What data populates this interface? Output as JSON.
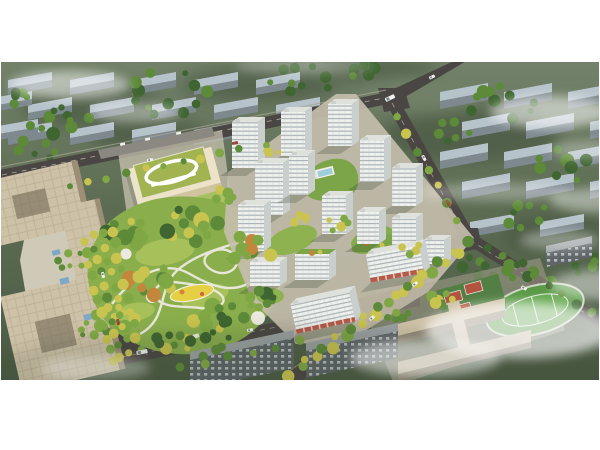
{
  "meta": {
    "type": "architectural-aerial-render",
    "description": "Bird's-eye masterplan rendering of a residential development: white high-rise apartment towers around green courtyards, a central landscaped park with a yellow playground, a kindergarten with a green roof and white loop, beige office towers and plaza to the west, a wide tree-lined avenue, a commercial street with red awnings, a school campus with running track and red courts to the southeast, all surrounded by a muted existing city with rows of grey slab buildings and drifting low clouds. White page margins above and below the render."
  },
  "landmarks": [
    {
      "name": "residential-towers",
      "desc": "Cluster of white high-rise apartment buildings with banded windows"
    },
    {
      "name": "central-park",
      "desc": "Landscaped park with winding white paths, lawns and playground"
    },
    {
      "name": "kindergarten",
      "desc": "Low school building with green roof and white racetrack loop"
    },
    {
      "name": "office-complex",
      "desc": "Beige office towers with rooftop grids and landscaped plaza"
    },
    {
      "name": "tree-lined-avenue",
      "desc": "Wide boulevard with four rows of yellow trees"
    },
    {
      "name": "commercial-street",
      "desc": "Retail frontage with red awnings along the boulevard"
    },
    {
      "name": "school-campus",
      "desc": "Long school buildings with green sports field, track and red courts"
    },
    {
      "name": "context-city",
      "desc": "Muted grey-green existing city blocks under light fog and clouds"
    }
  ],
  "palette": {
    "page_bg": "#ffffff",
    "terrain_top": "#73826a",
    "terrain_mid": "#5d6d53",
    "terrain_bottom": "#4b5a44",
    "context_roof": "#b7c3cb",
    "context_side": "#7d898f",
    "road": "#4a4643",
    "road_line": "#cfc9ba",
    "sidewalk": "#a8a194",
    "tower_front": "#eff1ed",
    "tower_side": "#c9cfcc",
    "tower_stripe": "#a2abb0",
    "roof_flat": "#dfe2dc",
    "courtyard_green": "#7ca448",
    "park_lawn": "#8aae4c",
    "lawn_light": "#a9c35c",
    "tree_dark": "#3f6530",
    "tree_mid": "#5d8a39",
    "tree_light": "#7fa845",
    "tree_yellow": "#c9c44f",
    "tree_orange": "#c3873c",
    "path_white": "#eceadf",
    "playground_yellow": "#e5d044",
    "pool_blue": "#9fcdd8",
    "plaza": "#d6cfbd",
    "office_roof": "#cdc1a7",
    "office_side": "#9d8f76",
    "kinder_roof": "#a2b452",
    "kinder_body": "#ece3c9",
    "school_roof": "#cfc2a8",
    "school_side": "#8f8572",
    "track_green": "#5a9a46",
    "field_green": "#63a84e",
    "court_red": "#b2543f",
    "court_pad": "#4f8040",
    "city_roof": "#9ba1a3",
    "city_front": "#5e6468",
    "city_window": "#c6ccce",
    "awning_red": "#b04a38",
    "canopy_blue": "#7fa7c9",
    "parking": "#8b8781",
    "cloud": "#ffffff",
    "shadow": "#26301f",
    "car_white": "#f2f2f0",
    "car_red": "#b03a2c"
  },
  "context": {
    "grids": [
      {
        "x0": 8,
        "y0": 80,
        "cols": 5,
        "rows": 3,
        "dx": 62,
        "dy": 25,
        "stagger": 20,
        "w": 44,
        "slope": 8,
        "rh": 8,
        "fh": 7,
        "skip": [
          "2,4"
        ]
      },
      {
        "x0": 440,
        "y0": 92,
        "cols": 3,
        "rows": 4,
        "dx": 64,
        "dy": 30,
        "stagger": 22,
        "w": 48,
        "slope": 9,
        "rh": 9,
        "fh": 8,
        "skip": []
      },
      {
        "x0": 470,
        "y0": 222,
        "cols": 2,
        "rows": 1,
        "dx": 70,
        "dy": 30,
        "stagger": 0,
        "w": 44,
        "slope": 8,
        "rh": 8,
        "fh": 7,
        "skip": []
      },
      {
        "x0": -8,
        "y0": 98,
        "cols": 1,
        "rows": 2,
        "dx": 60,
        "dy": 28,
        "stagger": 6,
        "w": 40,
        "slope": 7,
        "rh": 8,
        "fh": 6,
        "skip": []
      }
    ]
  },
  "towers": [
    {
      "x": 328,
      "y": 104,
      "w": 24,
      "h": 42
    },
    {
      "x": 281,
      "y": 112,
      "w": 24,
      "h": 44
    },
    {
      "x": 232,
      "y": 122,
      "w": 26,
      "h": 46
    },
    {
      "x": 360,
      "y": 140,
      "w": 24,
      "h": 42
    },
    {
      "x": 255,
      "y": 163,
      "w": 28,
      "h": 52
    },
    {
      "x": 289,
      "y": 155,
      "w": 19,
      "h": 40
    },
    {
      "x": 392,
      "y": 168,
      "w": 24,
      "h": 38
    },
    {
      "x": 238,
      "y": 205,
      "w": 26,
      "h": 46
    },
    {
      "x": 322,
      "y": 196,
      "w": 24,
      "h": 38
    },
    {
      "x": 357,
      "y": 212,
      "w": 22,
      "h": 32
    },
    {
      "x": 392,
      "y": 218,
      "w": 24,
      "h": 32
    },
    {
      "x": 424,
      "y": 240,
      "w": 20,
      "h": 24
    },
    {
      "x": 250,
      "y": 262,
      "w": 30,
      "h": 24
    },
    {
      "x": 295,
      "y": 254,
      "w": 34,
      "h": 26,
      "garden": true
    },
    {
      "x": 368,
      "y": 250,
      "w": 54,
      "h": 28,
      "shops": true,
      "rot": -10
    },
    {
      "x": 293,
      "y": 298,
      "w": 60,
      "h": 30,
      "shops": true,
      "rot": -12
    }
  ],
  "vegetation": {
    "clusters": [
      {
        "layer": "ctx",
        "cx": 60,
        "cy": 118,
        "spread": 34,
        "n": 10,
        "rmin": 3,
        "rmax": 7,
        "pal": [
          "tree_dark",
          "tree_mid"
        ]
      },
      {
        "layer": "ctx",
        "cx": 165,
        "cy": 95,
        "spread": 44,
        "n": 12,
        "rmin": 3,
        "rmax": 7,
        "pal": [
          "tree_dark",
          "tree_mid"
        ]
      },
      {
        "layer": "ctx",
        "cx": 300,
        "cy": 78,
        "spread": 34,
        "n": 9,
        "rmin": 3,
        "rmax": 6,
        "pal": [
          "tree_dark",
          "tree_mid"
        ]
      },
      {
        "layer": "ctx",
        "cx": 368,
        "cy": 68,
        "spread": 24,
        "n": 6,
        "rmin": 3,
        "rmax": 6,
        "pal": [
          "tree_dark",
          "tree_mid"
        ]
      },
      {
        "layer": "ctx",
        "cx": 495,
        "cy": 100,
        "spread": 40,
        "n": 10,
        "rmin": 3,
        "rmax": 7,
        "pal": [
          "tree_dark",
          "tree_mid"
        ]
      },
      {
        "layer": "ctx",
        "cx": 565,
        "cy": 165,
        "spread": 30,
        "n": 8,
        "rmin": 3,
        "rmax": 7,
        "pal": [
          "tree_dark",
          "tree_mid"
        ]
      },
      {
        "layer": "ctx",
        "cx": 520,
        "cy": 212,
        "spread": 26,
        "n": 7,
        "rmin": 3,
        "rmax": 6,
        "pal": [
          "tree_dark",
          "tree_mid"
        ]
      },
      {
        "layer": "ctx",
        "cx": 35,
        "cy": 150,
        "spread": 22,
        "n": 6,
        "rmin": 3,
        "rmax": 6,
        "pal": [
          "tree_dark",
          "tree_mid"
        ]
      },
      {
        "layer": "ctx",
        "cx": 450,
        "cy": 130,
        "spread": 22,
        "n": 6,
        "rmin": 3,
        "rmax": 6,
        "pal": [
          "tree_dark",
          "tree_mid"
        ]
      },
      {
        "layer": "ctx",
        "cx": 590,
        "cy": 262,
        "spread": 22,
        "n": 6,
        "rmin": 3,
        "rmax": 6,
        "pal": [
          "tree_dark",
          "tree_mid"
        ]
      },
      {
        "layer": "ctx",
        "cx": 553,
        "cy": 298,
        "spread": 28,
        "n": 8,
        "rmin": 3,
        "rmax": 7,
        "pal": [
          "tree_dark",
          "tree_mid"
        ]
      },
      {
        "layer": "ctx",
        "cx": 480,
        "cy": 268,
        "spread": 20,
        "n": 6,
        "rmin": 3,
        "rmax": 6,
        "pal": [
          "tree_dark",
          "tree_mid"
        ]
      },
      {
        "layer": "ctx",
        "cx": 18,
        "cy": 95,
        "spread": 16,
        "n": 5,
        "rmin": 3,
        "rmax": 6,
        "pal": [
          "tree_dark",
          "tree_mid"
        ]
      },
      {
        "layer": "site",
        "cx": 132,
        "cy": 232,
        "spread": 26,
        "n": 10,
        "rmin": 3.5,
        "rmax": 8,
        "pal": [
          "tree_mid",
          "tree_light",
          "tree_dark",
          "tree_yellow"
        ]
      },
      {
        "layer": "site",
        "cx": 192,
        "cy": 224,
        "spread": 30,
        "n": 12,
        "rmin": 3.5,
        "rmax": 8,
        "pal": [
          "tree_mid",
          "tree_light",
          "tree_dark",
          "tree_yellow"
        ]
      },
      {
        "layer": "site",
        "cx": 250,
        "cy": 250,
        "spread": 24,
        "n": 10,
        "rmin": 3.5,
        "rmax": 7,
        "pal": [
          "tree_mid",
          "tree_light",
          "tree_yellow",
          "tree_orange"
        ]
      },
      {
        "layer": "site",
        "cx": 150,
        "cy": 282,
        "spread": 28,
        "n": 11,
        "rmin": 3.5,
        "rmax": 8,
        "pal": [
          "tree_mid",
          "tree_light",
          "tree_orange",
          "tree_yellow"
        ]
      },
      {
        "layer": "site",
        "cx": 218,
        "cy": 318,
        "spread": 30,
        "n": 12,
        "rmin": 3.5,
        "rmax": 8,
        "pal": [
          "tree_dark",
          "tree_mid",
          "tree_light",
          "tree_yellow"
        ]
      },
      {
        "layer": "site",
        "cx": 116,
        "cy": 318,
        "spread": 20,
        "n": 8,
        "rmin": 3,
        "rmax": 7,
        "pal": [
          "tree_mid",
          "tree_light",
          "tree_yellow"
        ]
      },
      {
        "layer": "site",
        "cx": 264,
        "cy": 300,
        "spread": 18,
        "n": 8,
        "rmin": 3,
        "rmax": 7,
        "pal": [
          "tree_mid",
          "tree_light",
          "tree_dark"
        ]
      },
      {
        "layer": "site",
        "cx": 172,
        "cy": 342,
        "spread": 20,
        "n": 8,
        "rmin": 3,
        "rmax": 6,
        "pal": [
          "tree_mid",
          "tree_dark",
          "tree_yellow"
        ]
      },
      {
        "layer": "site",
        "cx": 70,
        "cy": 260,
        "spread": 15,
        "n": 6,
        "rmin": 2.5,
        "rmax": 5,
        "pal": [
          "tree_mid",
          "tree_light"
        ]
      },
      {
        "layer": "site",
        "cx": 95,
        "cy": 330,
        "spread": 15,
        "n": 6,
        "rmin": 2.5,
        "rmax": 5,
        "pal": [
          "tree_mid",
          "tree_light"
        ]
      },
      {
        "layer": "site",
        "cx": 226,
        "cy": 196,
        "spread": 14,
        "n": 5,
        "rmin": 3,
        "rmax": 6,
        "pal": [
          "tree_light",
          "tree_yellow"
        ]
      },
      {
        "layer": "site",
        "cx": 340,
        "cy": 224,
        "spread": 13,
        "n": 5,
        "rmin": 2.5,
        "rmax": 5,
        "pal": [
          "tree_yellow",
          "tree_light"
        ]
      },
      {
        "layer": "site",
        "cx": 300,
        "cy": 218,
        "spread": 9,
        "n": 4,
        "rmin": 2.5,
        "rmax": 5,
        "pal": [
          "tree_yellow",
          "tree_light"
        ]
      },
      {
        "layer": "site",
        "cx": 412,
        "cy": 248,
        "spread": 11,
        "n": 4,
        "rmin": 2.5,
        "rmax": 5,
        "pal": [
          "tree_yellow",
          "tree_light"
        ]
      },
      {
        "layer": "site",
        "cx": 270,
        "cy": 150,
        "spread": 10,
        "n": 4,
        "rmin": 2.5,
        "rmax": 5,
        "pal": [
          "tree_yellow",
          "tree_light"
        ]
      },
      {
        "layer": "site",
        "cx": 440,
        "cy": 300,
        "spread": 16,
        "n": 6,
        "rmin": 3,
        "rmax": 6,
        "pal": [
          "tree_mid",
          "tree_yellow",
          "tree_light"
        ]
      },
      {
        "layer": "site",
        "cx": 522,
        "cy": 272,
        "spread": 18,
        "n": 6,
        "rmin": 3,
        "rmax": 6,
        "pal": [
          "tree_dark",
          "tree_mid"
        ]
      },
      {
        "layer": "site",
        "cx": 210,
        "cy": 344,
        "spread": 22,
        "n": 7,
        "rmin": 3,
        "rmax": 6,
        "pal": [
          "tree_mid",
          "tree_dark"
        ]
      },
      {
        "layer": "site",
        "cx": 398,
        "cy": 316,
        "spread": 14,
        "n": 5,
        "rmin": 3,
        "rmax": 5,
        "pal": [
          "tree_mid",
          "tree_light"
        ]
      }
    ],
    "rows": [
      {
        "x1": 70,
        "y1": 186,
        "x2": 240,
        "y2": 149,
        "n": 10,
        "r": 3.5,
        "pal": [
          "tree_mid",
          "tree_yellow",
          "tree_light"
        ]
      },
      {
        "x1": 84,
        "y1": 240,
        "x2": 112,
        "y2": 362,
        "n": 11,
        "r": 4.5,
        "pal": [
          "tree_yellow",
          "tree_light"
        ]
      },
      {
        "x1": 93,
        "y1": 236,
        "x2": 121,
        "y2": 358,
        "n": 11,
        "r": 4,
        "pal": [
          "tree_yellow",
          "tree_mid"
        ]
      },
      {
        "x1": 102,
        "y1": 233,
        "x2": 130,
        "y2": 354,
        "n": 10,
        "r": 4,
        "pal": [
          "tree_light",
          "tree_yellow"
        ]
      },
      {
        "x1": 111,
        "y1": 231,
        "x2": 140,
        "y2": 351,
        "n": 10,
        "r": 4.5,
        "pal": [
          "tree_yellow",
          "tree_light"
        ]
      },
      {
        "x1": 290,
        "y1": 378,
        "x2": 460,
        "y2": 252,
        "n": 13,
        "r": 5,
        "pal": [
          "tree_yellow",
          "tree_light",
          "tree_yellow"
        ]
      },
      {
        "x1": 306,
        "y1": 360,
        "x2": 468,
        "y2": 242,
        "n": 12,
        "r": 4.5,
        "pal": [
          "tree_yellow",
          "tree_mid"
        ]
      },
      {
        "x1": 398,
        "y1": 116,
        "x2": 458,
        "y2": 222,
        "n": 7,
        "r": 4,
        "pal": [
          "tree_light",
          "tree_yellow",
          "tree_mid"
        ]
      },
      {
        "x1": 488,
        "y1": 246,
        "x2": 592,
        "y2": 312,
        "n": 8,
        "r": 4,
        "pal": [
          "tree_dark",
          "tree_mid"
        ]
      },
      {
        "x1": 180,
        "y1": 368,
        "x2": 300,
        "y2": 342,
        "n": 6,
        "r": 4,
        "pal": [
          "tree_mid",
          "tree_light"
        ]
      }
    ]
  },
  "cars": [
    {
      "x": 150,
      "y": 160,
      "a": -12,
      "c": "car_white"
    },
    {
      "x": 235,
      "y": 143,
      "a": -12,
      "c": "car_red"
    },
    {
      "x": 390,
      "y": 98,
      "a": -26,
      "c": "car_white",
      "w": 10,
      "h": 4
    },
    {
      "x": 432,
      "y": 77,
      "a": -26,
      "c": "car_white"
    },
    {
      "x": 424,
      "y": 158,
      "a": 61,
      "c": "car_white"
    },
    {
      "x": 448,
      "y": 203,
      "a": 61,
      "c": "car_red"
    },
    {
      "x": 524,
      "y": 288,
      "a": 32,
      "c": "car_white"
    },
    {
      "x": 372,
      "y": 318,
      "a": -40,
      "c": "car_white"
    },
    {
      "x": 415,
      "y": 284,
      "a": -40,
      "c": "car_white"
    },
    {
      "x": 103,
      "y": 275,
      "a": 77,
      "c": "car_white"
    },
    {
      "x": 118,
      "y": 322,
      "a": 77,
      "c": "car_red"
    },
    {
      "x": 142,
      "y": 352,
      "a": -11,
      "c": "car_white",
      "w": 11,
      "h": 4
    },
    {
      "x": 250,
      "y": 330,
      "a": -11,
      "c": "car_white"
    }
  ],
  "clouds": [
    {
      "x": 70,
      "y": 85,
      "rx": 60,
      "ry": 14,
      "o": 0.5
    },
    {
      "x": 135,
      "y": 112,
      "rx": 44,
      "ry": 10,
      "o": 0.38
    },
    {
      "x": 550,
      "y": 112,
      "rx": 60,
      "ry": 16,
      "o": 0.55
    },
    {
      "x": 595,
      "y": 200,
      "rx": 45,
      "ry": 12,
      "o": 0.42
    },
    {
      "x": 495,
      "y": 192,
      "rx": 75,
      "ry": 9,
      "o": 0.3
    },
    {
      "x": 585,
      "y": 150,
      "rx": 35,
      "ry": 10,
      "o": 0.3
    },
    {
      "x": 520,
      "y": 330,
      "rx": 95,
      "ry": 28,
      "o": 0.65
    },
    {
      "x": 425,
      "y": 358,
      "rx": 75,
      "ry": 18,
      "o": 0.5
    },
    {
      "x": 600,
      "y": 285,
      "rx": 50,
      "ry": 15,
      "o": 0.45
    },
    {
      "x": 560,
      "y": 240,
      "rx": 40,
      "ry": 10,
      "o": 0.35
    },
    {
      "x": 95,
      "y": 368,
      "rx": 55,
      "ry": 12,
      "o": 0.3
    },
    {
      "x": 305,
      "y": 66,
      "rx": 70,
      "ry": 8,
      "o": 0.25
    }
  ]
}
